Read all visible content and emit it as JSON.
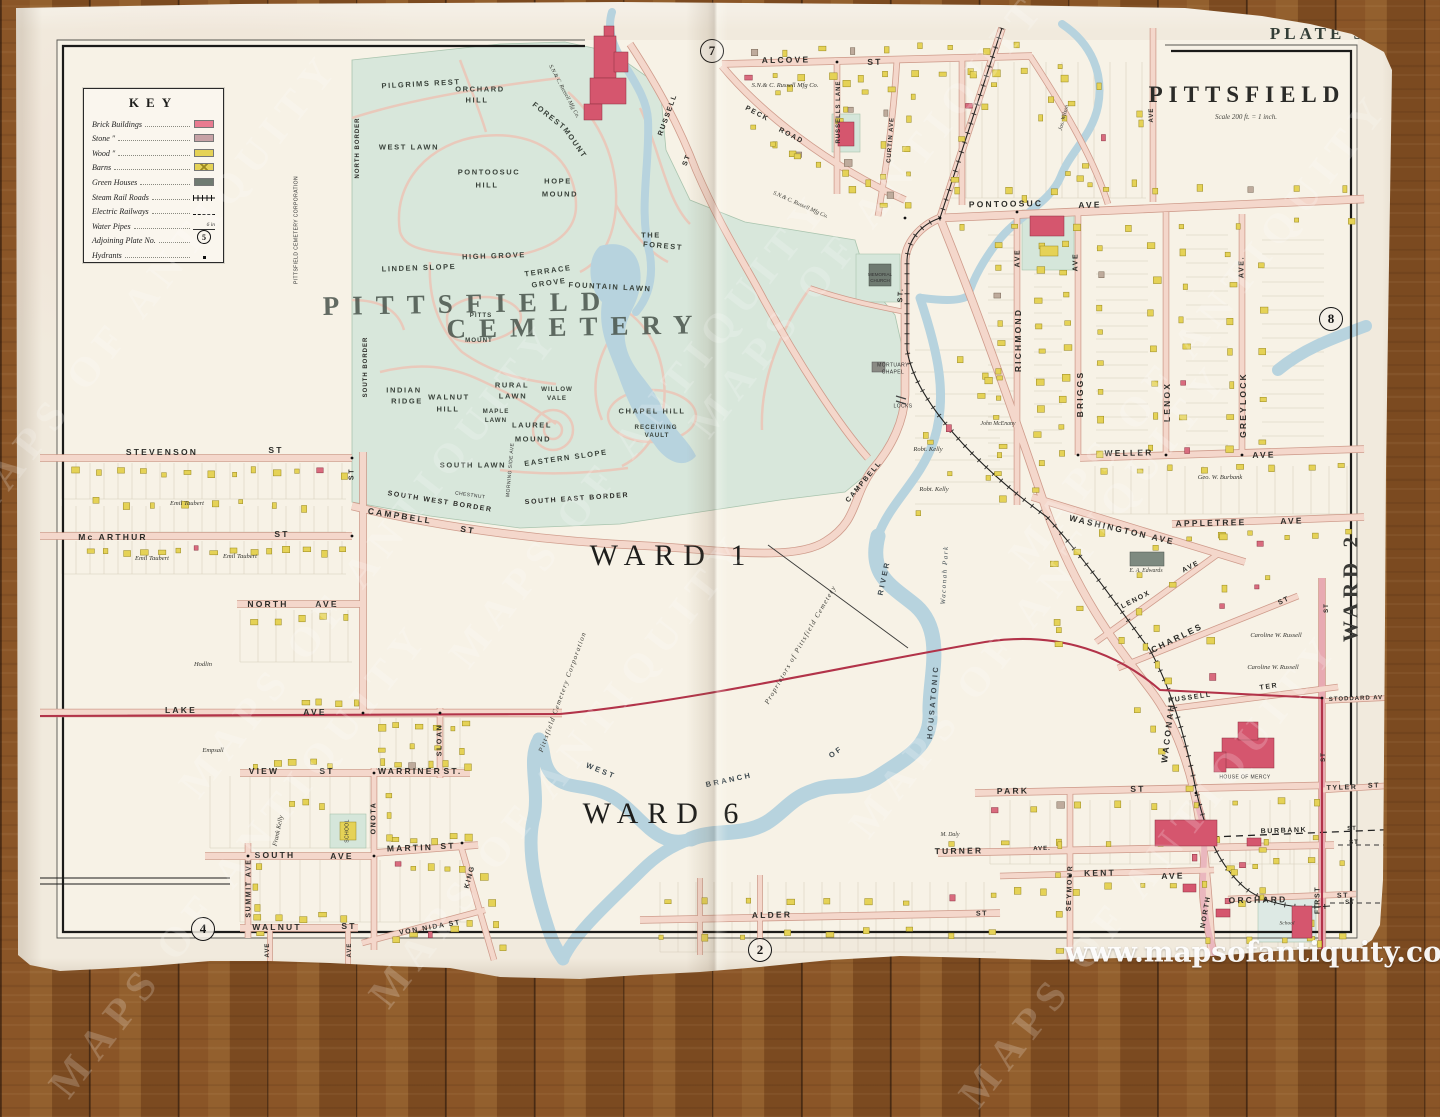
{
  "title": {
    "plate": "PLATE 5",
    "name": "PITTSFIELD",
    "scale": "Scale 200 ft. = 1 inch."
  },
  "photo": {
    "watermark_tile": "MAPS OF ANTIQUITY",
    "watermark_url": "www.mapsofantiquity.com"
  },
  "key": {
    "title": "KEY",
    "items": [
      {
        "label": "Brick Buildings",
        "type": "brick"
      },
      {
        "label": "Stone ″",
        "type": "stone"
      },
      {
        "label": "Wood ″",
        "type": "wood"
      },
      {
        "label": "Barns",
        "type": "barns"
      },
      {
        "label": "Green Houses",
        "type": "greenhouse"
      },
      {
        "label": "Steam Rail Roads",
        "type": "rail"
      },
      {
        "label": "Electric Railways",
        "type": "electric"
      },
      {
        "label": "Water Pipes",
        "type": "water",
        "note": "6 in"
      },
      {
        "label": "Adjoining Plate No.",
        "type": "plate",
        "value": "5"
      },
      {
        "label": "Hydrants",
        "type": "hydrant"
      }
    ]
  },
  "adjoining_plates": [
    [
      "7",
      712,
      51
    ],
    [
      "8",
      1331,
      319
    ],
    [
      "2",
      760,
      950
    ],
    [
      "4",
      203,
      929
    ]
  ],
  "colors": {
    "paper": "#f1eadd",
    "cemetery_green": "#d8e7db",
    "water": "#b7d3de",
    "road": "#f4d7cb",
    "brick_building": "#d5566e",
    "wood_building": "#e5d256",
    "stone_building": "#c7a2a6",
    "greenhouse": "#6f7a71",
    "electric_railway": "#b23349"
  },
  "wards": [
    "WARD 1",
    "WARD 6",
    "WARD 2"
  ],
  "labels": [
    [
      "STEVENSON",
      162,
      452,
      0,
      "st"
    ],
    [
      "ST",
      276,
      450,
      0,
      "st"
    ],
    [
      "Mc ARTHUR",
      113,
      537,
      0,
      "st"
    ],
    [
      "ST",
      282,
      534,
      0,
      "st"
    ],
    [
      "NORTH",
      268,
      604,
      0,
      "st"
    ],
    [
      "AVE",
      327,
      604,
      0,
      "st"
    ],
    [
      "LAKE",
      181,
      710,
      0,
      "st"
    ],
    [
      "AVE",
      315,
      712,
      0,
      "st"
    ],
    [
      "VIEW",
      264,
      771,
      0,
      "st"
    ],
    [
      "ST",
      327,
      771,
      0,
      "st"
    ],
    [
      "WARRINER",
      410,
      771,
      0,
      "st"
    ],
    [
      "ST.",
      453,
      771,
      0,
      "st"
    ],
    [
      "SOUTH",
      275,
      855,
      0,
      "st"
    ],
    [
      "AVE",
      342,
      856,
      0,
      "st"
    ],
    [
      "MARTIN",
      410,
      848,
      -2,
      "st"
    ],
    [
      "ST",
      448,
      846,
      -2,
      "st"
    ],
    [
      "WALNUT",
      277,
      927,
      0,
      "st"
    ],
    [
      "ST",
      349,
      926,
      0,
      "st"
    ],
    [
      "VON NIDA ST",
      430,
      928,
      -10,
      "s7"
    ],
    [
      "SUMMIT AVE",
      249,
      888,
      -90,
      "s7"
    ],
    [
      "ONOTA",
      374,
      818,
      -90,
      "s7"
    ],
    [
      "SLOAN",
      440,
      740,
      -90,
      "s7"
    ],
    [
      "KING",
      470,
      877,
      -75,
      "s7"
    ],
    [
      "AVE",
      268,
      950,
      -90,
      "s6"
    ],
    [
      "AVE",
      350,
      950,
      -90,
      "s6"
    ],
    [
      "ST",
      352,
      474,
      -90,
      "s7"
    ],
    [
      "CAMPBELL",
      400,
      516,
      9,
      "st"
    ],
    [
      "ST",
      468,
      530,
      9,
      "st"
    ],
    [
      "CAMPBELL",
      864,
      482,
      -50,
      "s7"
    ],
    [
      "ST.",
      901,
      295,
      -87,
      "s7"
    ],
    [
      "ALCOVE",
      786,
      60,
      -1,
      "st"
    ],
    [
      "ST",
      875,
      62,
      -1,
      "st"
    ],
    [
      "PECK",
      757,
      114,
      28,
      "s7"
    ],
    [
      "ROAD",
      791,
      136,
      28,
      "s7"
    ],
    [
      "RUSSELLS LANE",
      839,
      112,
      -90,
      "s6"
    ],
    [
      "CURTIN AVE",
      891,
      140,
      -86,
      "s6"
    ],
    [
      "RUSSELL",
      668,
      115,
      -70,
      "s7"
    ],
    [
      "ST",
      687,
      160,
      -70,
      "s7"
    ],
    [
      "PONTOOSUC",
      1006,
      204,
      -1,
      "st"
    ],
    [
      "AVE",
      1090,
      205,
      -1,
      "st"
    ],
    [
      "AVE",
      1152,
      115,
      -90,
      "s6"
    ],
    [
      "RICHMOND",
      1018,
      340,
      -90,
      "st"
    ],
    [
      "AVE",
      1018,
      258,
      -90,
      "s7"
    ],
    [
      "BRIGGS",
      1080,
      394,
      -90,
      "st"
    ],
    [
      "AVE",
      1076,
      262,
      -90,
      "s7"
    ],
    [
      "LENOX",
      1167,
      402,
      -90,
      "st"
    ],
    [
      "GREYLOCK",
      1243,
      405,
      -90,
      "st"
    ],
    [
      "AVE.",
      1242,
      267,
      -90,
      "s7"
    ],
    [
      "WELLER",
      1129,
      453,
      -1,
      "st"
    ],
    [
      "AVE",
      1264,
      455,
      -1,
      "st"
    ],
    [
      "WASHINGTON AVE",
      1122,
      530,
      13,
      "st"
    ],
    [
      "APPLETREE",
      1211,
      523,
      -1,
      "st"
    ],
    [
      "AVE",
      1292,
      521,
      -1,
      "st"
    ],
    [
      "LENOX",
      1136,
      600,
      -27,
      "s7"
    ],
    [
      "AVE",
      1191,
      567,
      -27,
      "s7"
    ],
    [
      "CHARLES",
      1177,
      638,
      -26,
      "st"
    ],
    [
      "ST",
      1284,
      601,
      -26,
      "s7"
    ],
    [
      "RUSSELL",
      1190,
      698,
      -8,
      "s7"
    ],
    [
      "TER",
      1269,
      687,
      -8,
      "s7"
    ],
    [
      "WACONAH",
      1168,
      733,
      -83,
      "st"
    ],
    [
      "STODDARD AV",
      1356,
      699,
      -2,
      "s6"
    ],
    [
      "TYLER",
      1342,
      788,
      -2,
      "s7"
    ],
    [
      "ST",
      1374,
      786,
      -2,
      "s7"
    ],
    [
      "FIRST",
      1318,
      900,
      -90,
      "s7"
    ],
    [
      "ST",
      1327,
      608,
      -90,
      "s6"
    ],
    [
      "ST",
      1324,
      757,
      -90,
      "s6"
    ],
    [
      "ST",
      1354,
      843,
      0,
      "s6"
    ],
    [
      "ST",
      1350,
      903,
      0,
      "s6"
    ],
    [
      "PARK",
      1013,
      791,
      -1,
      "st"
    ],
    [
      "ST",
      1138,
      789,
      -1,
      "st"
    ],
    [
      "TURNER",
      959,
      851,
      -1,
      "st"
    ],
    [
      "AVE.",
      1042,
      849,
      -1,
      "s6"
    ],
    [
      "KENT",
      1100,
      873,
      -1,
      "st"
    ],
    [
      "AVE",
      1173,
      876,
      -1,
      "st"
    ],
    [
      "BURBANK",
      1284,
      831,
      -2,
      "s7"
    ],
    [
      "ST",
      1352,
      829,
      -2,
      "s6"
    ],
    [
      "ORCHARD",
      1258,
      900,
      -1,
      "st"
    ],
    [
      "ST",
      1343,
      896,
      -1,
      "s7"
    ],
    [
      "SEYMOUR",
      1070,
      888,
      -88,
      "s7"
    ],
    [
      "NORTH",
      1206,
      912,
      -80,
      "s7"
    ],
    [
      "ALDER",
      772,
      915,
      -1,
      "st"
    ],
    [
      "ST",
      982,
      914,
      -1,
      "s7"
    ],
    [
      "NORTH BORDER",
      358,
      148,
      -90,
      "s6"
    ],
    [
      "SOUTH BORDER",
      366,
      367,
      -90,
      "s6"
    ],
    [
      "SOUTH WEST BORDER",
      440,
      502,
      9,
      "s7"
    ],
    [
      "SOUTH EAST BORDER",
      577,
      499,
      -4,
      "s7"
    ],
    [
      "PITTSFIELD CEMETERY CORPORATION",
      297,
      230,
      -90,
      "tiny5"
    ],
    [
      "CHESTNUT",
      470,
      496,
      8,
      "tiny5"
    ],
    [
      "MORNING SIDE AVE",
      511,
      470,
      -85,
      "tiny5"
    ],
    [
      "PILGRIMS REST",
      421,
      84,
      -3,
      "sec"
    ],
    [
      "ORCHARD",
      480,
      89,
      0,
      "sec"
    ],
    [
      "HILL",
      477,
      100,
      0,
      "sec"
    ],
    [
      "FOREST",
      549,
      116,
      38,
      "sec"
    ],
    [
      "MOUNT",
      575,
      143,
      55,
      "sec"
    ],
    [
      "WEST LAWN",
      409,
      147,
      0,
      "sec"
    ],
    [
      "PONTOOSUC",
      489,
      172,
      0,
      "sec"
    ],
    [
      "HILL",
      487,
      185,
      0,
      "sec"
    ],
    [
      "HOPE",
      558,
      181,
      0,
      "sec"
    ],
    [
      "MOUND",
      560,
      194,
      0,
      "sec"
    ],
    [
      "THE",
      651,
      235,
      0,
      "sec"
    ],
    [
      "FOREST",
      663,
      246,
      5,
      "sec"
    ],
    [
      "LINDEN SLOPE",
      419,
      268,
      -2,
      "sec"
    ],
    [
      "HIGH GROVE",
      494,
      256,
      -2,
      "sec"
    ],
    [
      "TERRACE",
      548,
      271,
      -8,
      "sec"
    ],
    [
      "GROVE",
      549,
      283,
      -8,
      "sec"
    ],
    [
      "FOUNTAIN LAWN",
      610,
      287,
      3,
      "sec"
    ],
    [
      "PITTS",
      481,
      316,
      0,
      "sec6"
    ],
    [
      "MOUNT",
      479,
      341,
      0,
      "sec6"
    ],
    [
      "INDIAN",
      404,
      390,
      0,
      "sec"
    ],
    [
      "RIDGE",
      407,
      401,
      0,
      "sec"
    ],
    [
      "WALNUT",
      449,
      397,
      0,
      "sec"
    ],
    [
      "HILL",
      448,
      409,
      0,
      "sec"
    ],
    [
      "RURAL",
      512,
      385,
      0,
      "sec"
    ],
    [
      "LAWN",
      513,
      396,
      0,
      "sec"
    ],
    [
      "WILLOW",
      557,
      390,
      0,
      "sec6"
    ],
    [
      "VALE",
      557,
      399,
      0,
      "sec6"
    ],
    [
      "MAPLE",
      496,
      412,
      0,
      "sec6"
    ],
    [
      "LAWN",
      496,
      421,
      0,
      "sec6"
    ],
    [
      "LAUREL",
      532,
      425,
      0,
      "sec"
    ],
    [
      "MOUND",
      533,
      439,
      0,
      "sec"
    ],
    [
      "CHAPEL HILL",
      652,
      411,
      0,
      "sec"
    ],
    [
      "RECEIVING",
      656,
      428,
      0,
      "sec6"
    ],
    [
      "VAULT",
      657,
      436,
      0,
      "sec6"
    ],
    [
      "SOUTH LAWN",
      473,
      465,
      0,
      "sec"
    ],
    [
      "EASTERN SLOPE",
      566,
      458,
      -8,
      "sec"
    ],
    [
      "PITTSFIELD",
      468,
      304,
      -1,
      "big"
    ],
    [
      "CEMETERY",
      576,
      327,
      -1,
      "big"
    ],
    [
      "WARD 1",
      672,
      556,
      0,
      "ward"
    ],
    [
      "WARD 6",
      665,
      814,
      0,
      "ward"
    ],
    [
      "WARD 2",
      1351,
      587,
      -90,
      "ward2"
    ],
    [
      "WEST",
      601,
      771,
      22,
      "riv"
    ],
    [
      "BRANCH",
      729,
      780,
      -12,
      "riv"
    ],
    [
      "OF",
      836,
      752,
      -35,
      "riv"
    ],
    [
      "HOUSATONIC",
      933,
      702,
      -85,
      "riv"
    ],
    [
      "RIVER",
      884,
      578,
      -78,
      "riv"
    ],
    [
      "Waconah Park",
      945,
      575,
      -87,
      "rivi"
    ],
    [
      "Proprietors of Pittsfield Cemetery",
      801,
      645,
      -60,
      "propd"
    ],
    [
      "Pittsfield Cemetery Corporation",
      563,
      692,
      -70,
      "propd"
    ],
    [
      "Emil Taubert",
      187,
      504,
      0,
      "prop"
    ],
    [
      "Emil Taubert",
      152,
      559,
      0,
      "prop"
    ],
    [
      "Emil Taubert",
      240,
      557,
      0,
      "prop"
    ],
    [
      "Hodlin",
      203,
      665,
      0,
      "prop"
    ],
    [
      "Empsall",
      213,
      751,
      0,
      "prop"
    ],
    [
      "Frank Kelly",
      279,
      831,
      -78,
      "prop"
    ],
    [
      "Robt. Kelly",
      928,
      450,
      0,
      "prop"
    ],
    [
      "Robt. Kelly",
      934,
      490,
      0,
      "prop"
    ],
    [
      "John McEnany",
      998,
      425,
      0,
      "prop6"
    ],
    [
      "Geo. W. Burbank",
      1220,
      478,
      0,
      "prop"
    ],
    [
      "Caroline W. Russell",
      1276,
      636,
      0,
      "prop"
    ],
    [
      "Caroline W. Russell",
      1273,
      668,
      0,
      "prop"
    ],
    [
      "S.N.& C. Russell Mfg Co.",
      785,
      86,
      0,
      "prop"
    ],
    [
      "S.N.& C. Russell Mfg Co.",
      563,
      92,
      62,
      "prop6"
    ],
    [
      "S.N.& C. Russell Mfg Co.",
      800,
      206,
      24,
      "prop6"
    ],
    [
      "Jos. Wilson",
      1065,
      118,
      -75,
      "prop6"
    ],
    [
      "M. Daly",
      950,
      836,
      0,
      "prop6"
    ],
    [
      "E. A. Edwards",
      1146,
      572,
      0,
      "prop6"
    ],
    [
      "MORTUARY",
      893,
      366,
      0,
      "tiny5"
    ],
    [
      "CHAPEL",
      893,
      373,
      0,
      "tiny5"
    ],
    [
      "LOCKS",
      903,
      407,
      0,
      "tiny5"
    ],
    [
      "SCHOOL",
      348,
      831,
      -90,
      "tiny5"
    ],
    [
      "School",
      1287,
      924,
      0,
      "propt"
    ],
    [
      "HOUSE OF MERCY",
      1245,
      778,
      0,
      "tiny5"
    ],
    [
      "MEMORIAL",
      880,
      275,
      0,
      "tiny4"
    ],
    [
      "CHURCH",
      880,
      281,
      0,
      "tiny4"
    ]
  ],
  "watermark_positions": [
    [
      150,
      290
    ],
    [
      370,
      560
    ],
    [
      240,
      860
    ],
    [
      640,
      430
    ],
    [
      560,
      770
    ],
    [
      880,
      200
    ],
    [
      1040,
      600
    ],
    [
      1200,
      330
    ],
    [
      1150,
      870
    ]
  ]
}
